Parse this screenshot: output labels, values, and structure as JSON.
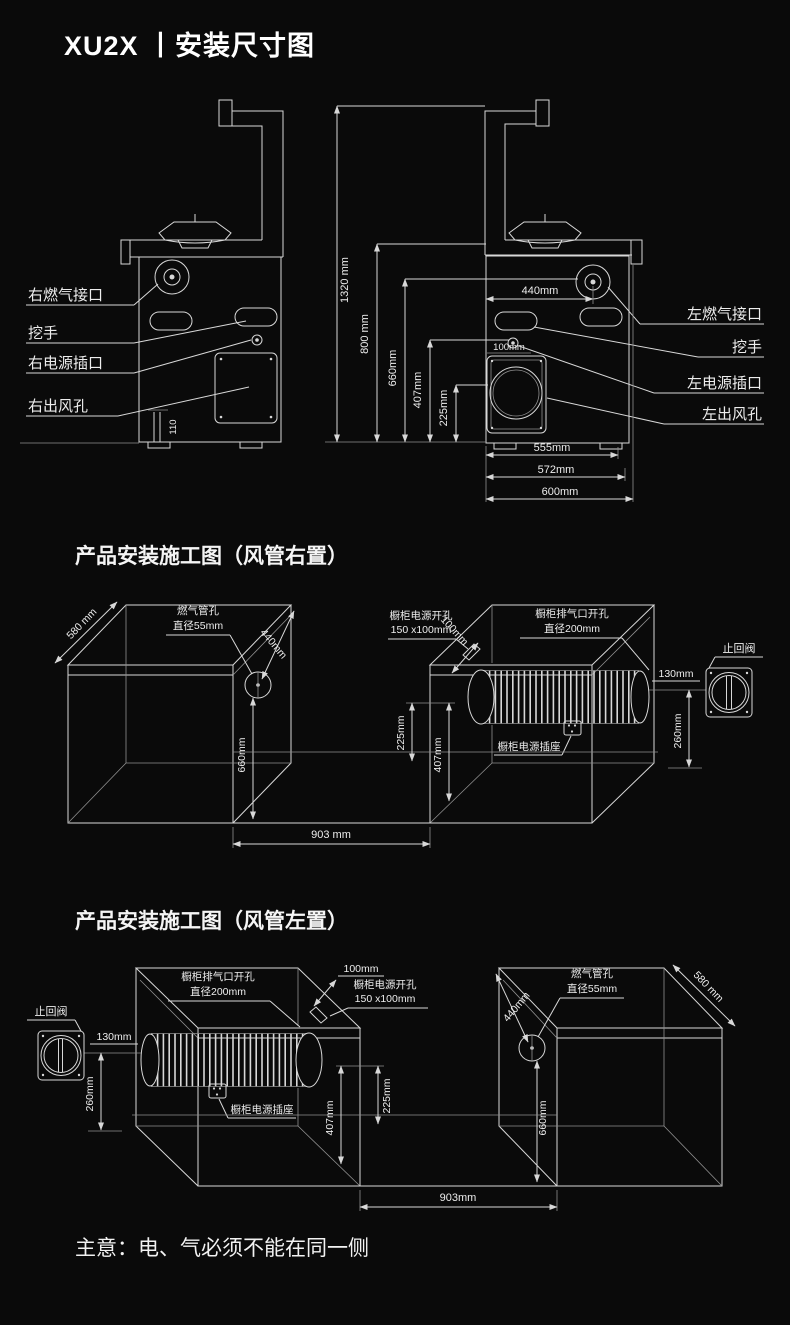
{
  "page": {
    "title": "XU2X 丨安装尺寸图",
    "note": "主意：电、气必须不能在同一侧"
  },
  "colors": {
    "background": "#0a0a0a",
    "line": "#d8d8d8",
    "text": "#ededed"
  },
  "front_views": {
    "left_view": {
      "gas": "右燃气接口",
      "handle": "挖手",
      "power": "右电源插口",
      "outlet": "右出风孔",
      "base_height": "110"
    },
    "right_view": {
      "gas": "左燃气接口",
      "handle": "挖手",
      "power": "左电源插口",
      "outlet": "左出风孔",
      "socket_offset": "100mm",
      "dims": {
        "h_total": "1320 mm",
        "h_body": "800 mm",
        "h_gas": "660mm",
        "h_power": "407mm",
        "h_outlet": "225mm",
        "w_gas": "440mm",
        "w_inner": "555mm",
        "w_mid": "572mm",
        "w_outer": "600mm"
      }
    }
  },
  "duct_right": {
    "heading": "产品安装施工图（风管右置）",
    "depth": "580 mm",
    "gas_hole_1": "燃气管孔",
    "gas_hole_2": "直径55mm",
    "gas_offset": "440mm",
    "gas_height": "660mm",
    "power_hole_1": "橱柜电源开孔",
    "power_hole_2": "150 x100mm",
    "power_offset": "100mm",
    "vent_hole_1": "橱柜排气口开孔",
    "vent_hole_2": "直径200mm",
    "check_valve": "止回阀",
    "valve_gap": "130mm",
    "valve_height": "260mm",
    "duct_low": "225mm",
    "duct_high": "407mm",
    "socket": "橱柜电源插座",
    "span": "903 mm"
  },
  "duct_left": {
    "heading": "产品安装施工图（风管左置）",
    "depth": "580 mm",
    "gas_hole_1": "燃气管孔",
    "gas_hole_2": "直径55mm",
    "gas_offset": "440mm",
    "gas_height": "660mm",
    "power_hole_1": "橱柜电源开孔",
    "power_hole_2": "150 x100mm",
    "power_offset": "100mm",
    "vent_hole_1": "橱柜排气口开孔",
    "vent_hole_2": "直径200mm",
    "check_valve": "止回阀",
    "valve_gap": "130mm",
    "valve_height": "260mm",
    "duct_low": "225mm",
    "duct_high": "407mm",
    "socket": "橱柜电源插座",
    "span": "903mm"
  }
}
